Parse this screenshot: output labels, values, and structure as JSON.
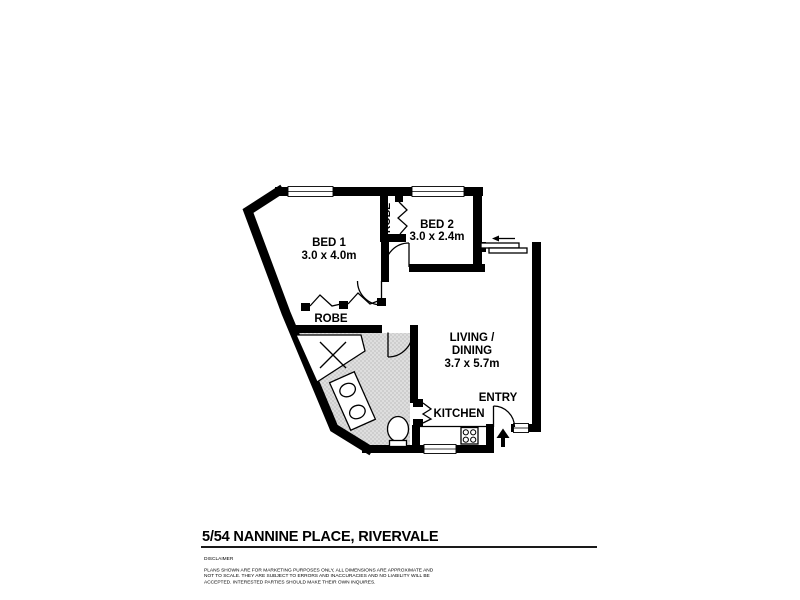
{
  "plan": {
    "rooms": {
      "bed1": {
        "label": "BED 1",
        "dims": "3.0 x 4.0m"
      },
      "bed2": {
        "label": "BED 2",
        "dims": "3.0 x 2.4m"
      },
      "robe_bed1": {
        "label": "ROBE"
      },
      "robe_bed2": {
        "label": "ROBE"
      },
      "living_dining": {
        "label_line1": "LIVING /",
        "label_line2": "DINING",
        "dims": "3.7 x 5.7m"
      },
      "kitchen": {
        "label": "KITCHEN"
      },
      "entry": {
        "label": "ENTRY"
      }
    },
    "colors": {
      "wall": "#000000",
      "wet_area_fill": "#dedede",
      "wet_area_dot": "#8f8f8f"
    }
  },
  "footer": {
    "address": "5/54 NANNINE PLACE, RIVERVALE",
    "disclaimer_heading": "DISCLAIMER",
    "disclaimer_lines": [
      "PLANS SHOWN ARE FOR MARKETING PURPOSES ONLY, ALL DIMENSIONS ARE APPROXIMATE AND",
      "NOT TO SCALE. THEY ARE SUBJECT TO ERRORS AND INACCURACIES AND NO LIABILITY WILL BE",
      "ACCEPTED. INTERESTED PARTIES SHOULD MAKE THEIR OWN INQUIRES."
    ]
  }
}
